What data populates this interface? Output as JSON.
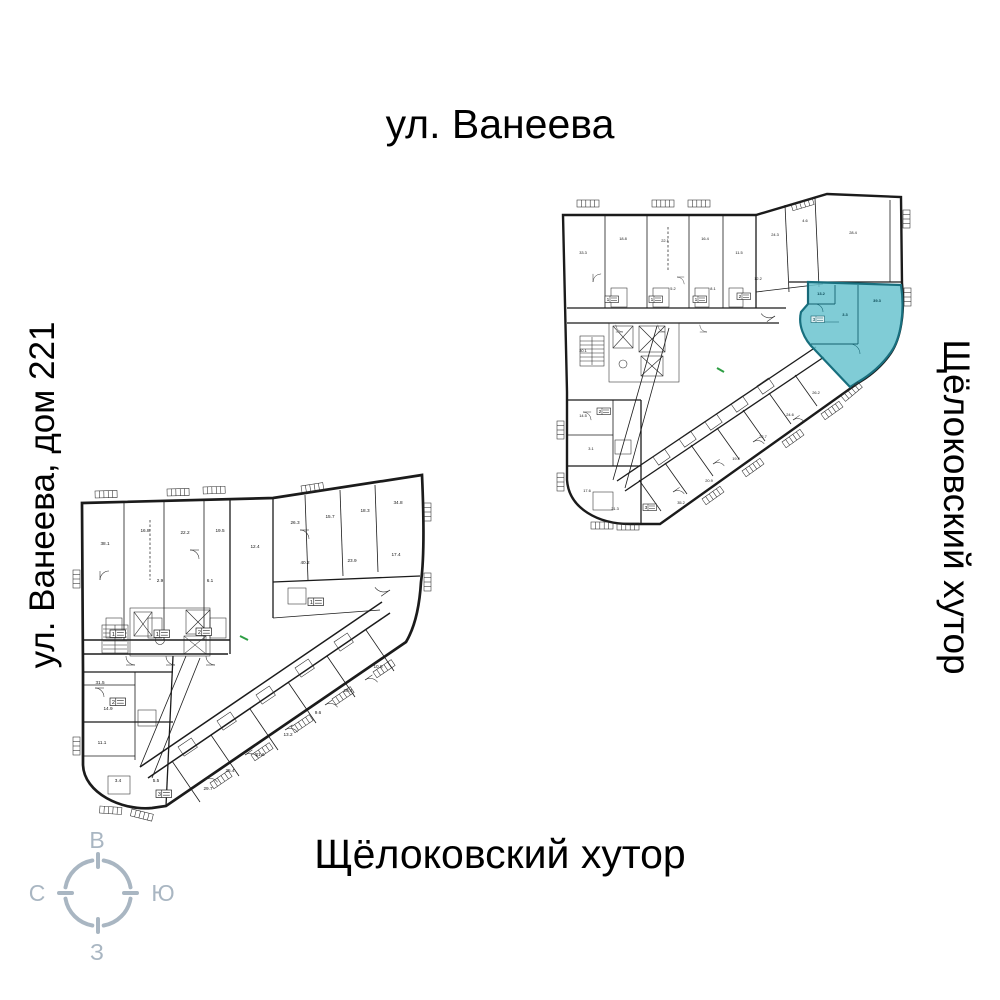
{
  "labels": {
    "street_top": "ул. Ванеева",
    "street_left": "ул. Ванеева, дом 221",
    "street_right": "Щёлоковский хутор",
    "street_bottom": "Щёлоковский хутор"
  },
  "compass": {
    "top": "В",
    "right": "Ю",
    "bottom": "З",
    "left": "С"
  },
  "colors": {
    "highlight_fill": "#6ac3cf",
    "highlight_border": "#186f7e",
    "plan_line": "#1b1b1b",
    "compass": "#a9b6c2",
    "entrance_marker": "#2e9e44"
  },
  "plans": {
    "small": {
      "area_labels": [
        "33.3",
        "18.8",
        "22.1",
        "16.4",
        "11.5",
        "24.3",
        "4.6",
        "28.4",
        "30.1",
        "14.5",
        "3.1",
        "17.6",
        "21.3",
        "35.2",
        "20.9",
        "19.8",
        "22.7",
        "24.6",
        "26.2",
        "5.2",
        "8.1",
        "12.2"
      ],
      "badges": [
        "1",
        "1",
        "1",
        "2",
        "2",
        "3"
      ],
      "highlight": {
        "badge": "3",
        "area": "39.3",
        "label_a": "13.2",
        "label_b": "3.3"
      }
    },
    "large": {
      "area_labels": [
        "38.1",
        "16.8",
        "22.2",
        "19.5",
        "12.4",
        "26.3",
        "15.7",
        "18.3",
        "34.8",
        "40.2",
        "23.9",
        "17.4",
        "31.5",
        "14.9",
        "11.1",
        "3.4",
        "5.5",
        "29.7",
        "25.4",
        "21.6",
        "13.2",
        "9.6",
        "20.1",
        "10.8",
        "6.1",
        "2.9"
      ],
      "badges": [
        "1",
        "1",
        "2",
        "1",
        "2",
        "3"
      ]
    }
  }
}
